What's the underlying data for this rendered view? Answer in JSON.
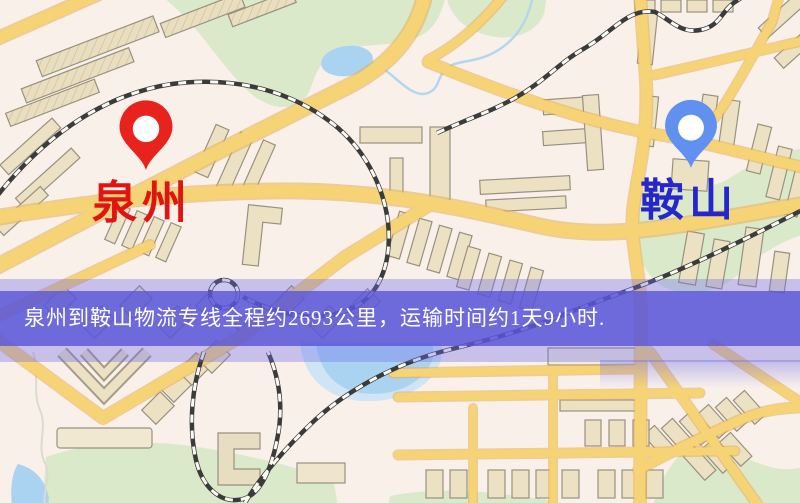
{
  "banner": {
    "text": "泉州到鞍山物流专线全程约2693公里，运输时间约1天9小时.",
    "background_color": "#5854d7",
    "text_color": "#ffffff"
  },
  "markers": {
    "origin": {
      "label": "泉州",
      "label_color": "#e01410",
      "pin_color": "#e8221c",
      "pin_hole_color": "#ffffff"
    },
    "destination": {
      "label": "鞍山",
      "label_color": "#2526cb",
      "pin_color": "#6090f0",
      "pin_hole_color": "#ffffff"
    }
  },
  "map_palette": {
    "background": "#f8f0e9",
    "road_fill": "#f6d375",
    "road_casing": "#e6ae54",
    "park": "#dbe9cb",
    "water": "#a9d3f1",
    "water_wash": "#cfe4f4",
    "railway_dark": "#3b3b3b",
    "railway_light": "#fdfaf4",
    "building_fill": "#ece2c3",
    "building_stroke": "#98917f"
  }
}
